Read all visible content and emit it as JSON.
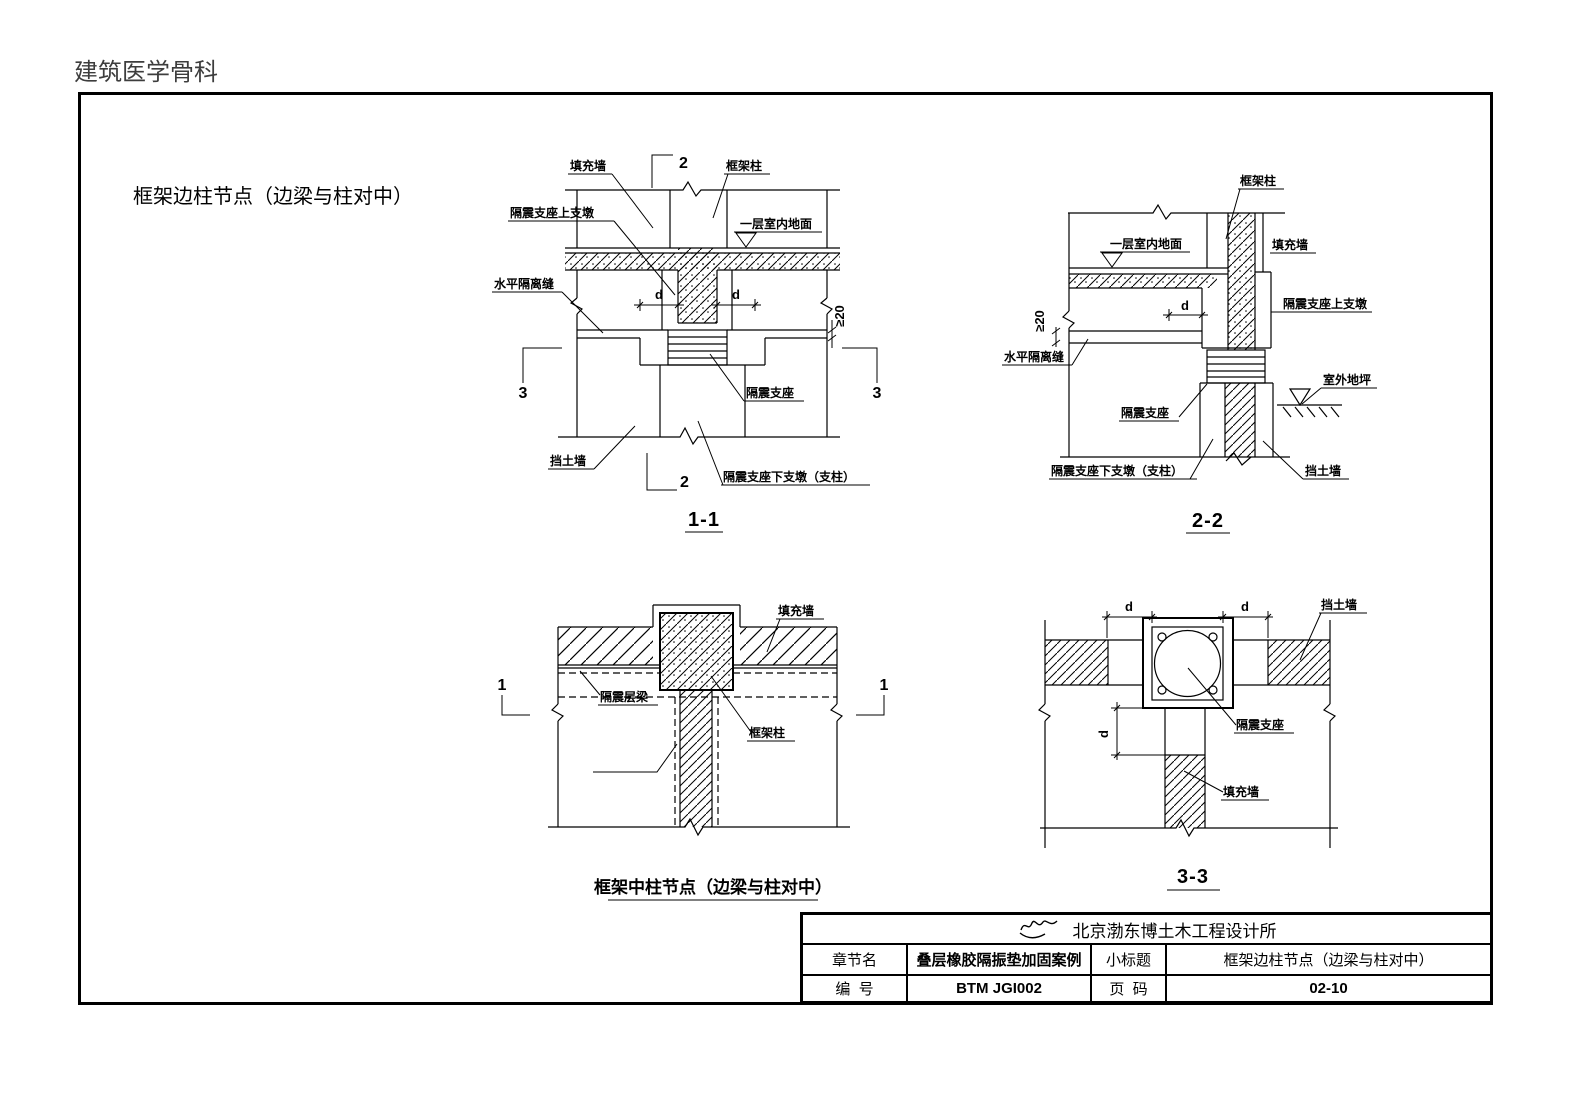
{
  "page": {
    "watermark": "建筑医学骨科",
    "title": "框架边柱节点（边梁与柱对中）"
  },
  "labels": {
    "infill_wall": "填充墙",
    "frame_column": "框架柱",
    "bearing_upper_pier": "隔震支座上支墩",
    "indoor_floor": "一层室内地面",
    "horizontal_seam": "水平隔离缝",
    "retaining_wall": "挡土墙",
    "bearing": "隔震支座",
    "bearing_lower_pier": "隔震支座下支墩（支柱）",
    "isolation_beam": "隔震层梁",
    "outdoor_ground": "室外地坪",
    "dim_d": "d",
    "dim_gap": "≥20"
  },
  "marks": {
    "s1": "1",
    "s2": "2",
    "s3": "3"
  },
  "captions": {
    "section_1_1": "1-1",
    "section_2_2": "2-2",
    "section_3_3": "3-3",
    "mid_column_node": "框架中柱节点（边梁与柱对中）"
  },
  "title_block": {
    "company": "北京渤东博土木工程设计所",
    "chapter_label": "章节名",
    "chapter_value": "叠层橡胶隔振垫加固案例",
    "subtitle_label": "小标题",
    "subtitle_value": "框架边柱节点（边梁与柱对中）",
    "number_label": "编  号",
    "number_value": "BTM JGI002",
    "page_label": "页  码",
    "page_value": "02-10"
  }
}
